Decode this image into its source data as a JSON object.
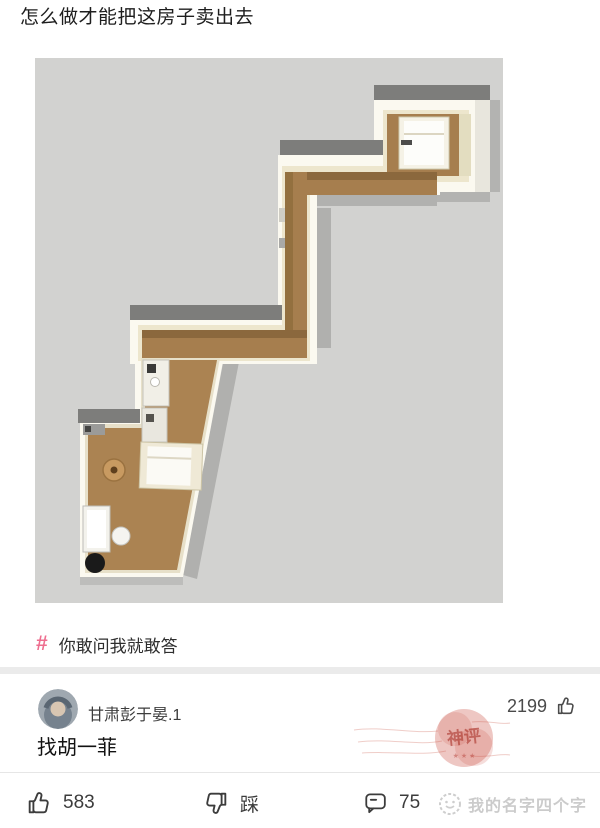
{
  "title": "怎么做才能把这房子卖出去",
  "topic": {
    "hash_symbol": "#",
    "label": "你敢问我就敢答"
  },
  "comment": {
    "username": "甘肃彭于晏.1",
    "like_count": "2199",
    "text": "找胡一菲",
    "stamp_label": "神评",
    "stamp_stars": "★ ★ ★"
  },
  "actions": {
    "like_count": "583",
    "dislike_label": "踩",
    "comment_count": "75"
  },
  "watermark": {
    "text": "我的名字四个字"
  },
  "colors": {
    "topic_pink": "#ee6e8f",
    "stamp_red": "#c84438",
    "canvas_gray": "#d2d2d0",
    "floor_brown": "#a67e4e",
    "roof_gray": "#7d7d7b"
  }
}
